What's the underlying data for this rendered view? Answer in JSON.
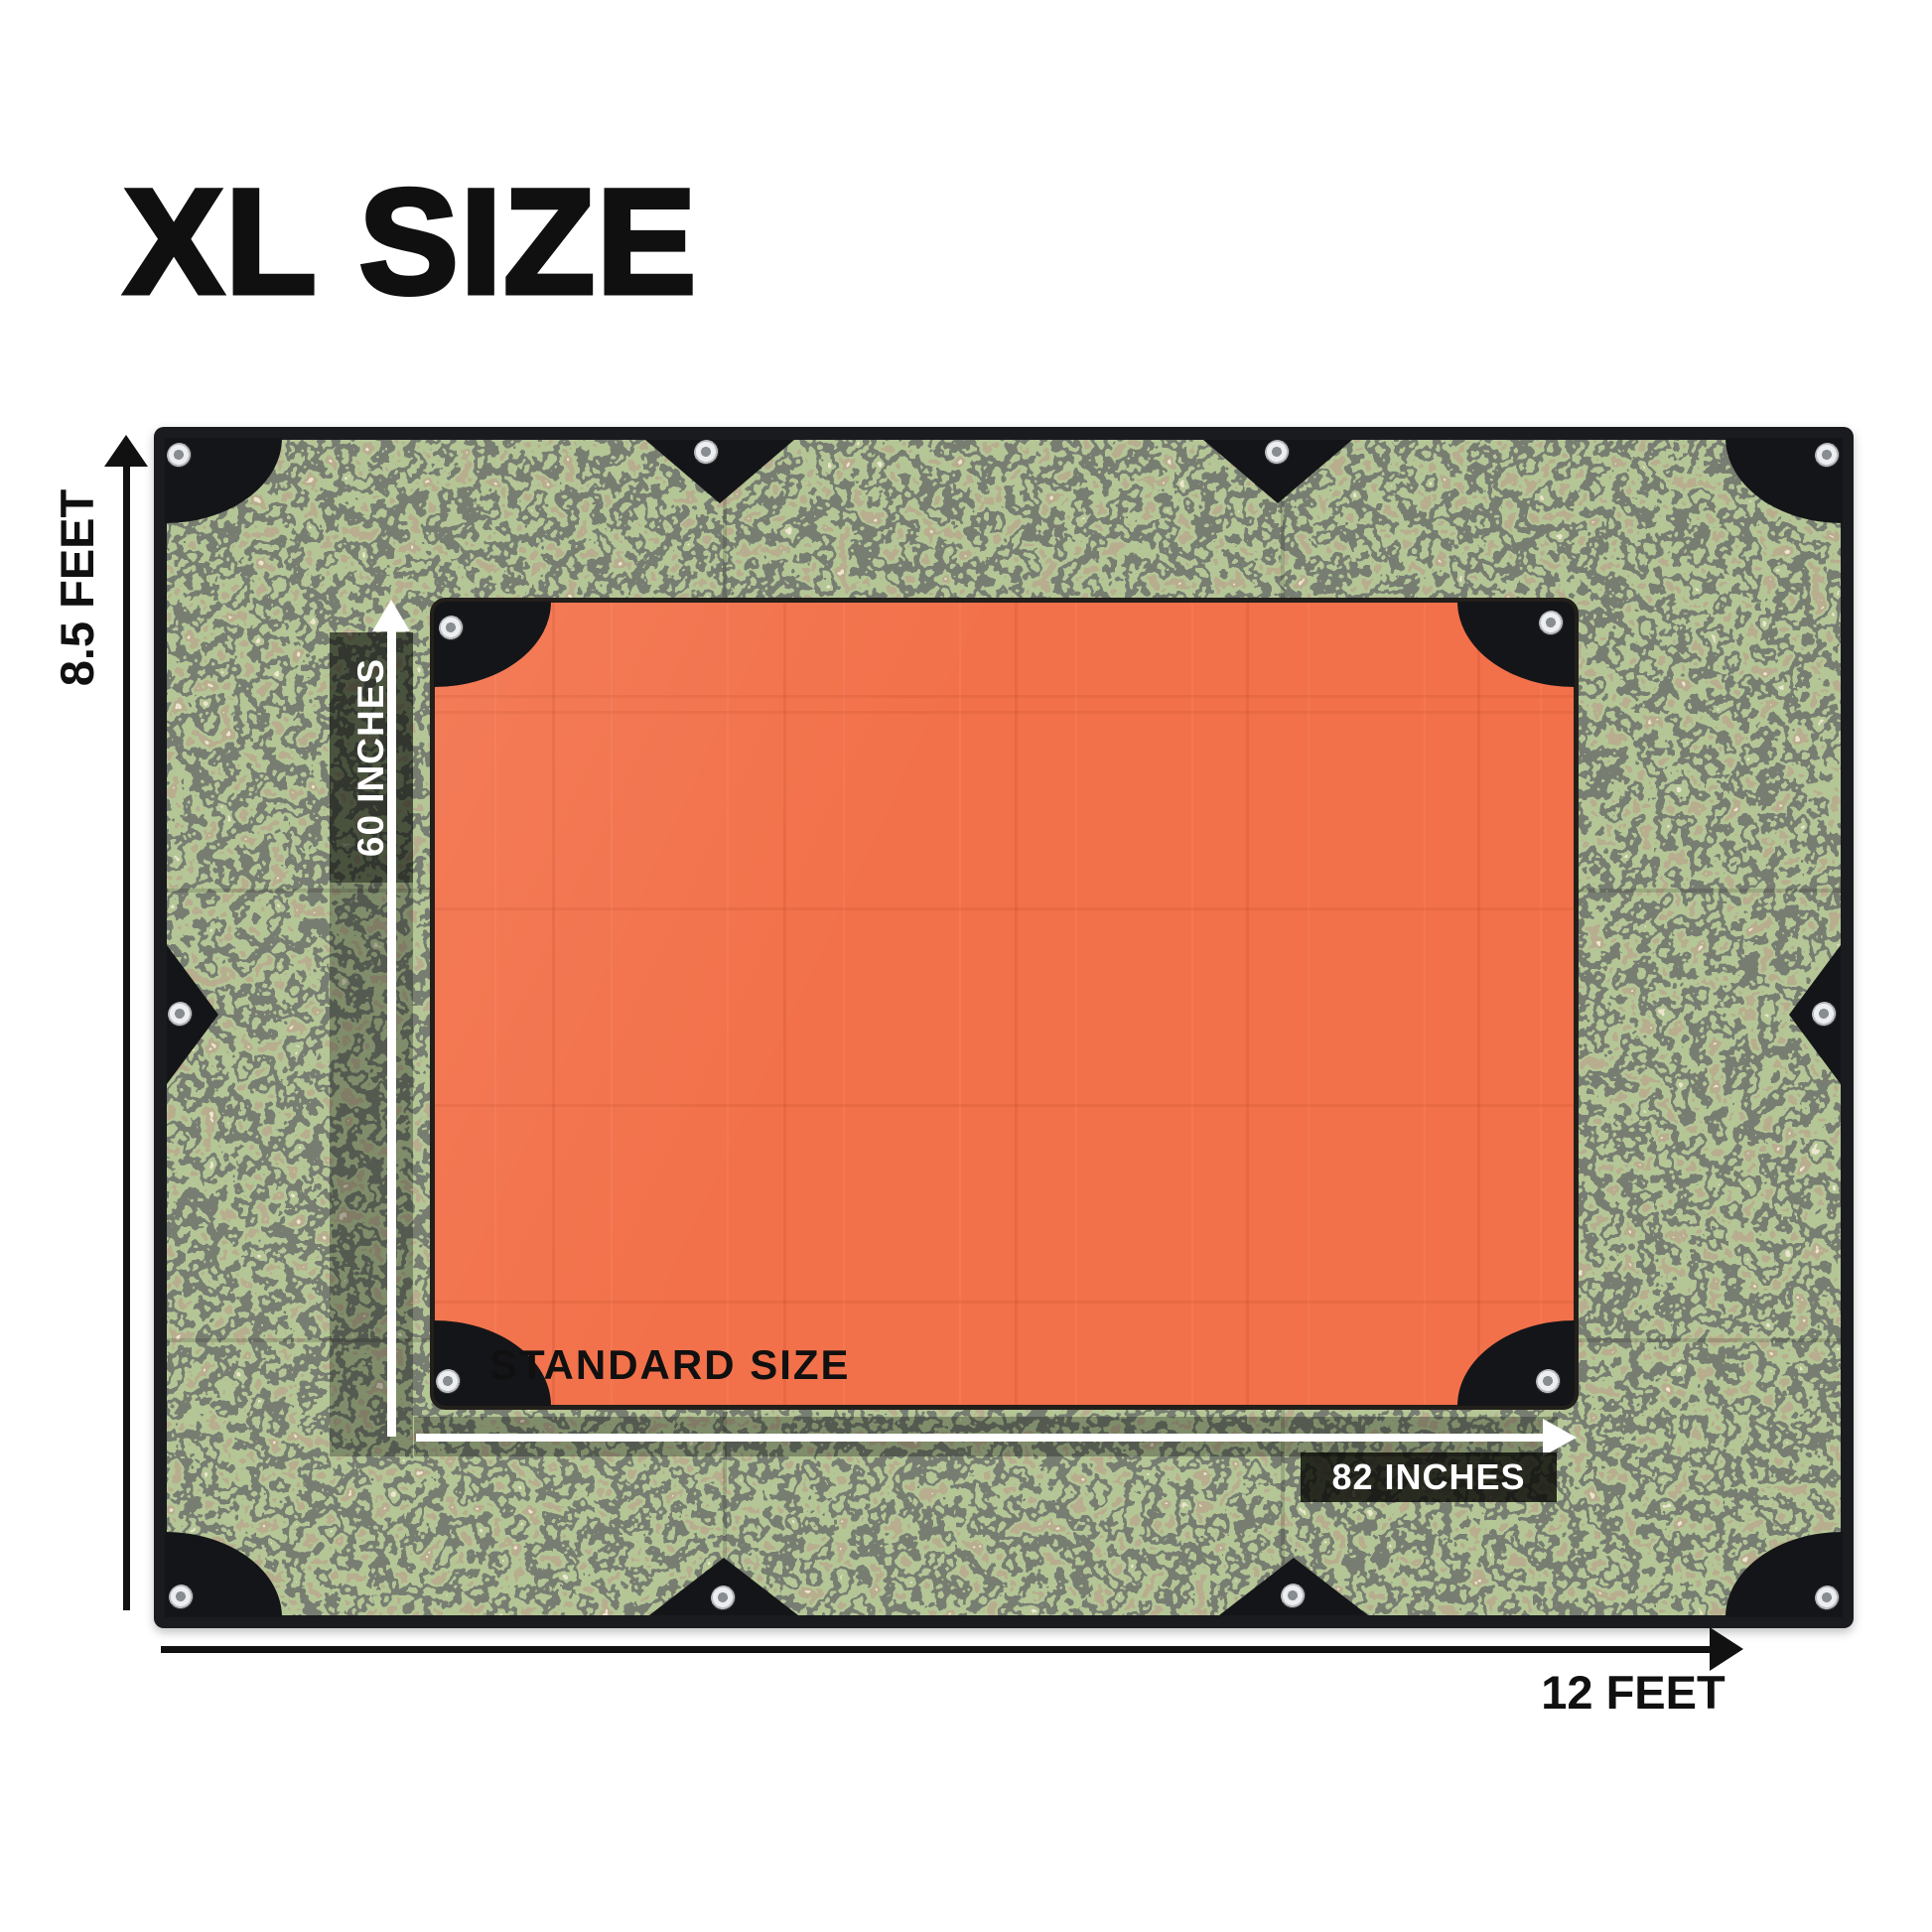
{
  "title": "XL SIZE",
  "dimensions": {
    "xl_height": "8.5 FEET",
    "xl_width": "12 FEET",
    "standard_height": "60 INCHES",
    "standard_width": "82 INCHES"
  },
  "labels": {
    "standard_size": "STANDARD SIZE"
  },
  "icons": {
    "grommet": "metal-eyelet-ring"
  },
  "colors": {
    "background": "#ffffff",
    "text": "#101010",
    "arrow_black": "#111111",
    "arrow_white": "#ffffff",
    "tarp_binding": "#191b1e",
    "patch_black": "#141518",
    "camo_base": "#4a4d41",
    "camo_green": "#75904e",
    "camo_tan": "#d8c9a0",
    "camo_brown": "#7b6a45",
    "camo_dark": "#2e3027",
    "standard_orange": "#f2714a",
    "label_overlay_soft": "rgba(8,10,6,0.30)",
    "label_overlay_strong": "rgba(8,10,6,0.45)",
    "label_overlay_dense": "rgba(8,10,6,0.82)"
  }
}
